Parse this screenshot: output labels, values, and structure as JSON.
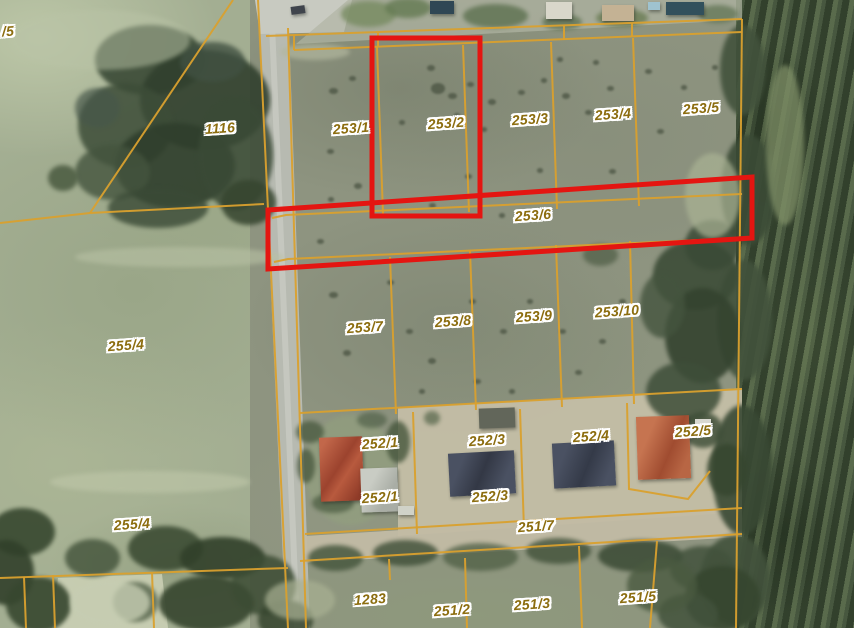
{
  "map": {
    "type": "cadastral-aerial-map",
    "width": 854,
    "height": 628,
    "colors": {
      "boundary": "#d9a02e",
      "highlight": "#e41511",
      "label_text": "#8c6d0f",
      "label_halo": "#ffffff",
      "road": "#b7bab1",
      "road_stripe": "#cfd1c8",
      "pavement": "#c8cac1",
      "dirt": "#c6bfa7",
      "forest": "#47573f",
      "field": "#a3ae92",
      "scrub": "#8e9480"
    },
    "labels": [
      {
        "text": "/5",
        "x": 8,
        "y": 31
      },
      {
        "text": "1116",
        "x": 220,
        "y": 128
      },
      {
        "text": "253/1",
        "x": 351,
        "y": 128
      },
      {
        "text": "253/2",
        "x": 446,
        "y": 123
      },
      {
        "text": "253/3",
        "x": 530,
        "y": 119
      },
      {
        "text": "253/4",
        "x": 613,
        "y": 114
      },
      {
        "text": "253/5",
        "x": 701,
        "y": 108
      },
      {
        "text": "253/6",
        "x": 533,
        "y": 215
      },
      {
        "text": "253/7",
        "x": 365,
        "y": 327
      },
      {
        "text": "253/8",
        "x": 453,
        "y": 321
      },
      {
        "text": "253/9",
        "x": 534,
        "y": 316
      },
      {
        "text": "253/10",
        "x": 617,
        "y": 311
      },
      {
        "text": "255/4",
        "x": 126,
        "y": 345
      },
      {
        "text": "255/4",
        "x": 132,
        "y": 524
      },
      {
        "text": "252/1",
        "x": 380,
        "y": 443
      },
      {
        "text": "252/1",
        "x": 380,
        "y": 497
      },
      {
        "text": "252/3",
        "x": 487,
        "y": 440
      },
      {
        "text": "252/3",
        "x": 490,
        "y": 496
      },
      {
        "text": "252/4",
        "x": 591,
        "y": 436
      },
      {
        "text": "252/5",
        "x": 693,
        "y": 431
      },
      {
        "text": "251/7",
        "x": 536,
        "y": 526
      },
      {
        "text": "1283",
        "x": 370,
        "y": 599
      },
      {
        "text": "251/2",
        "x": 452,
        "y": 610
      },
      {
        "text": "251/3",
        "x": 532,
        "y": 604
      },
      {
        "text": "251/5",
        "x": 638,
        "y": 597
      }
    ],
    "boundaries": [
      "233,0 90,213",
      "90,213 0,223",
      "90,213 264,204",
      "258,0 288,628",
      "288,28 306,628",
      "266,36 742,19",
      "294,50 742,32",
      "294,36 294,50",
      "378,33 378,47",
      "564,26 564,40",
      "632,23 632,37",
      "377,47 383,214",
      "463,45 469,212",
      "551,42 557,209",
      "633,38 639,206",
      "742,19 736,628",
      "272,218 286,215 742,194",
      "274,262 288,259 742,238",
      "300,413 742,389",
      "390,257 396,414",
      "470,251 476,410",
      "556,245 562,407",
      "630,241 634,404",
      "413,412 417,534",
      "520,409 524,530",
      "627,403 629,489 688,499 710,471",
      "305,534 742,508",
      "300,561 742,534",
      "465,558 467,628",
      "579,546 582,628",
      "657,541 650,628",
      "389,559 390,580",
      "0,578 288,568",
      "24,577 26,628",
      "53,575 55,628",
      "152,572 154,628"
    ],
    "highlights": [
      {
        "name": "highlight-parcel-253-2",
        "points": "372,38 480,38 480,216 372,216"
      },
      {
        "name": "highlight-parcel-253-6",
        "points": "268,210 752,177 752,238 268,269"
      }
    ],
    "terrain": [
      {
        "points": "258,0 288,0 310,628 286,628",
        "fill": "#b7bab1",
        "opacity": 1
      },
      {
        "points": "268,0 274,0 300,628 294,628",
        "fill": "#cfd1c8",
        "opacity": 0.6
      },
      {
        "points": "255,0 352,0 344,32 260,34",
        "fill": "#c8cac1",
        "opacity": 1
      },
      {
        "points": "348,0 742,0 742,20 296,44",
        "fill": "#b0b5a4",
        "opacity": 0.7
      },
      {
        "points": "398,408 742,388 742,512 398,536",
        "fill": "#c6bfa7",
        "opacity": 0.92
      },
      {
        "points": "305,536 742,509 742,537 301,563",
        "fill": "#c2bba4",
        "opacity": 0.95
      },
      {
        "points": "58,578 162,574 168,628 52,628",
        "fill": "#ccd1b6",
        "opacity": 0.85
      }
    ],
    "vegetation": [
      [
        150,
        60,
        110,
        70,
        "#3a4a36",
        0.9
      ],
      [
        205,
        100,
        130,
        100,
        "#31402e",
        0.9
      ],
      [
        125,
        125,
        95,
        85,
        "#3d4d38",
        0.85
      ],
      [
        175,
        165,
        120,
        85,
        "#2f3e2c",
        0.9
      ],
      [
        235,
        155,
        75,
        110,
        "#3a4a36",
        0.85
      ],
      [
        112,
        172,
        75,
        55,
        "#44543e",
        0.8
      ],
      [
        248,
        202,
        55,
        45,
        "#36452f",
        0.85
      ],
      [
        158,
        208,
        100,
        40,
        "#3a4a36",
        0.8
      ],
      [
        212,
        62,
        65,
        40,
        "#415142",
        0.8
      ],
      [
        97,
        108,
        45,
        40,
        "#47574a",
        0.7
      ],
      [
        63,
        178,
        30,
        26,
        "#4a5a40",
        0.85
      ],
      [
        742,
        70,
        45,
        90,
        "#42523c",
        0.9
      ],
      [
        748,
        190,
        55,
        110,
        "#3b4b36",
        0.9
      ],
      [
        744,
        320,
        55,
        120,
        "#42523c",
        0.9
      ],
      [
        742,
        470,
        60,
        130,
        "#394934",
        0.9
      ],
      [
        735,
        580,
        70,
        90,
        "#42523c",
        0.9
      ],
      [
        695,
        275,
        85,
        70,
        "#3c4c37",
        0.9
      ],
      [
        702,
        335,
        75,
        95,
        "#34432f",
        0.9
      ],
      [
        683,
        392,
        75,
        60,
        "#3e4e39",
        0.85
      ],
      [
        662,
        305,
        45,
        65,
        "#44543e",
        0.8
      ],
      [
        712,
        245,
        55,
        50,
        "#3a4a36",
        0.85
      ],
      [
        600,
        255,
        35,
        22,
        "#4e5d45",
        0.7
      ],
      [
        350,
        470,
        90,
        110,
        "#93a37e",
        0.5
      ],
      [
        335,
        558,
        55,
        26,
        "#48583f",
        0.85
      ],
      [
        405,
        553,
        65,
        26,
        "#3e4e37",
        0.8
      ],
      [
        480,
        557,
        75,
        28,
        "#4e5e44",
        0.75
      ],
      [
        558,
        551,
        65,
        26,
        "#42523a",
        0.8
      ],
      [
        640,
        556,
        85,
        32,
        "#3a4a34",
        0.85
      ],
      [
        702,
        568,
        65,
        45,
        "#42523c",
        0.85
      ],
      [
        722,
        598,
        75,
        65,
        "#36462f",
        0.9
      ],
      [
        688,
        614,
        60,
        40,
        "#42523c",
        0.85
      ],
      [
        662,
        585,
        70,
        55,
        "#4a5a40",
        0.8
      ],
      [
        22,
        532,
        65,
        48,
        "#37472f",
        0.9
      ],
      [
        6,
        572,
        55,
        65,
        "#31402a",
        0.9
      ],
      [
        38,
        604,
        65,
        55,
        "#37472f",
        0.9
      ],
      [
        92,
        558,
        55,
        38,
        "#42523a",
        0.8
      ],
      [
        165,
        548,
        75,
        45,
        "#37472f",
        0.85
      ],
      [
        222,
        558,
        85,
        42,
        "#31402a",
        0.9
      ],
      [
        206,
        603,
        95,
        55,
        "#36452e",
        0.9
      ],
      [
        263,
        585,
        65,
        60,
        "#3c4c34",
        0.85
      ],
      [
        135,
        602,
        45,
        40,
        "#42523a",
        0.7
      ],
      [
        285,
        620,
        55,
        40,
        "#36452e",
        0.85
      ],
      [
        110,
        602,
        80,
        45,
        "#c6cdb2",
        0.8
      ],
      [
        310,
        432,
        28,
        22,
        "#4c5c42",
        0.8
      ],
      [
        398,
        442,
        24,
        42,
        "#46563c",
        0.8
      ],
      [
        333,
        503,
        42,
        20,
        "#4e5e44",
        0.75
      ],
      [
        372,
        420,
        30,
        16,
        "#52624a",
        0.7
      ],
      [
        306,
        466,
        18,
        34,
        "#46563c",
        0.75
      ],
      [
        703,
        430,
        40,
        36,
        "#3c4c36",
        0.8
      ],
      [
        727,
        470,
        40,
        52,
        "#36462f",
        0.85
      ],
      [
        432,
        418,
        16,
        14,
        "#55654a",
        0.7
      ],
      [
        368,
        14,
        55,
        26,
        "#778b61",
        0.8
      ],
      [
        408,
        8,
        46,
        20,
        "#647a52",
        0.8
      ],
      [
        495,
        16,
        65,
        24,
        "#5d7150",
        0.8
      ],
      [
        562,
        22,
        40,
        16,
        "#5d7150",
        0.75
      ],
      [
        622,
        18,
        52,
        18,
        "#66794f",
        0.75
      ],
      [
        718,
        14,
        40,
        18,
        "#5d7150",
        0.7
      ],
      [
        712,
        195,
        55,
        85,
        "#aab394",
        0.7
      ],
      [
        180,
        257,
        210,
        20,
        "#b8c1a4",
        0.6
      ],
      [
        150,
        482,
        200,
        22,
        "#bfc7a9",
        0.6
      ],
      [
        300,
        600,
        70,
        40,
        "#a9b193",
        0.7
      ],
      [
        100,
        40,
        180,
        60,
        "#b9c3a6",
        0.5
      ],
      [
        785,
        145,
        38,
        160,
        "#7e8e66",
        0.75
      ],
      [
        315,
        52,
        70,
        16,
        "#b2b79e",
        0.7
      ]
    ],
    "bushes": [
      [
        333,
        92,
        9
      ],
      [
        352,
        79,
        7
      ],
      [
        431,
        69,
        8
      ],
      [
        438,
        90,
        14
      ],
      [
        452,
        97,
        9
      ],
      [
        470,
        85,
        7
      ],
      [
        492,
        103,
        8
      ],
      [
        521,
        93,
        7
      ],
      [
        544,
        81,
        6
      ],
      [
        566,
        97,
        8
      ],
      [
        610,
        89,
        7
      ],
      [
        648,
        72,
        7
      ],
      [
        588,
        113,
        7
      ],
      [
        402,
        123,
        6
      ],
      [
        330,
        152,
        7
      ],
      [
        358,
        187,
        8
      ],
      [
        331,
        200,
        6
      ],
      [
        468,
        177,
        7
      ],
      [
        540,
        171,
        6
      ],
      [
        612,
        172,
        7
      ],
      [
        660,
        132,
        7
      ],
      [
        432,
        206,
        7
      ],
      [
        502,
        216,
        6
      ],
      [
        320,
        242,
        7
      ],
      [
        333,
        296,
        9
      ],
      [
        347,
        354,
        8
      ],
      [
        390,
        283,
        7
      ],
      [
        409,
        332,
        7
      ],
      [
        432,
        362,
        8
      ],
      [
        472,
        302,
        7
      ],
      [
        503,
        332,
        7
      ],
      [
        530,
        302,
        6
      ],
      [
        562,
        332,
        7
      ],
      [
        602,
        342,
        7
      ],
      [
        622,
        302,
        7
      ],
      [
        578,
        373,
        7
      ],
      [
        477,
        382,
        7
      ],
      [
        422,
        392,
        6
      ],
      [
        512,
        392,
        6
      ],
      [
        457,
        116,
        6
      ],
      [
        484,
        130,
        6
      ],
      [
        560,
        60,
        6
      ],
      [
        596,
        63,
        6
      ],
      [
        684,
        88,
        6
      ],
      [
        715,
        68,
        6
      ]
    ],
    "buildings": [
      {
        "name": "house-red-roof",
        "x": 320,
        "y": 437,
        "w": 43,
        "h": 64,
        "rot": -2,
        "bg": "linear-gradient(125deg,#c2674a 10%,#9c432e 45%,#b85a3e 60%,#8f3b28 90%)"
      },
      {
        "name": "garage-light",
        "x": 361,
        "y": 468,
        "w": 37,
        "h": 44,
        "rot": -2,
        "bg": "linear-gradient(120deg,#c9ccc4 30%,#a9ada5 70%)"
      },
      {
        "name": "building-dark-roof-a",
        "x": 449,
        "y": 452,
        "w": 66,
        "h": 43,
        "rot": -3,
        "bg": "linear-gradient(115deg,#4a5162 20%,#333845 50%,#4a5162 80%)"
      },
      {
        "name": "building-dark-roof-b",
        "x": 553,
        "y": 442,
        "w": 62,
        "h": 45,
        "rot": -3,
        "bg": "linear-gradient(115deg,#4a5162 20%,#343a48 55%,#4a5162 85%)"
      },
      {
        "name": "building-orange-roof",
        "x": 637,
        "y": 416,
        "w": 53,
        "h": 63,
        "rot": -2,
        "bg": "linear-gradient(115deg,#c67450 25%,#a04c30 60%,#b86644 85%)"
      },
      {
        "name": "shed-dark",
        "x": 479,
        "y": 408,
        "w": 36,
        "h": 20,
        "rot": -2,
        "bg": "#62665a"
      },
      {
        "name": "structure-white",
        "x": 695,
        "y": 419,
        "w": 16,
        "h": 10,
        "rot": 0,
        "bg": "#d8d8d0"
      },
      {
        "name": "van-white",
        "x": 398,
        "y": 506,
        "w": 16,
        "h": 9,
        "rot": 0,
        "bg": "#d0d2c8"
      },
      {
        "name": "car-dark",
        "x": 291,
        "y": 6,
        "w": 14,
        "h": 8,
        "rot": -8,
        "bg": "#3f444c"
      },
      {
        "name": "pool-dark-a",
        "x": 430,
        "y": 1,
        "w": 24,
        "h": 13,
        "rot": 0,
        "bg": "#2f4754"
      },
      {
        "name": "building-white-top",
        "x": 546,
        "y": 2,
        "w": 26,
        "h": 17,
        "rot": 0,
        "bg": "#d9d7ca"
      },
      {
        "name": "building-beige-top",
        "x": 602,
        "y": 5,
        "w": 32,
        "h": 16,
        "rot": 0,
        "bg": "#c4b294"
      },
      {
        "name": "pool-dark-b",
        "x": 666,
        "y": 2,
        "w": 38,
        "h": 13,
        "rot": 0,
        "bg": "#32505c"
      },
      {
        "name": "pool-lightblue",
        "x": 648,
        "y": 2,
        "w": 12,
        "h": 8,
        "rot": 0,
        "bg": "#9fc3cf"
      }
    ]
  }
}
